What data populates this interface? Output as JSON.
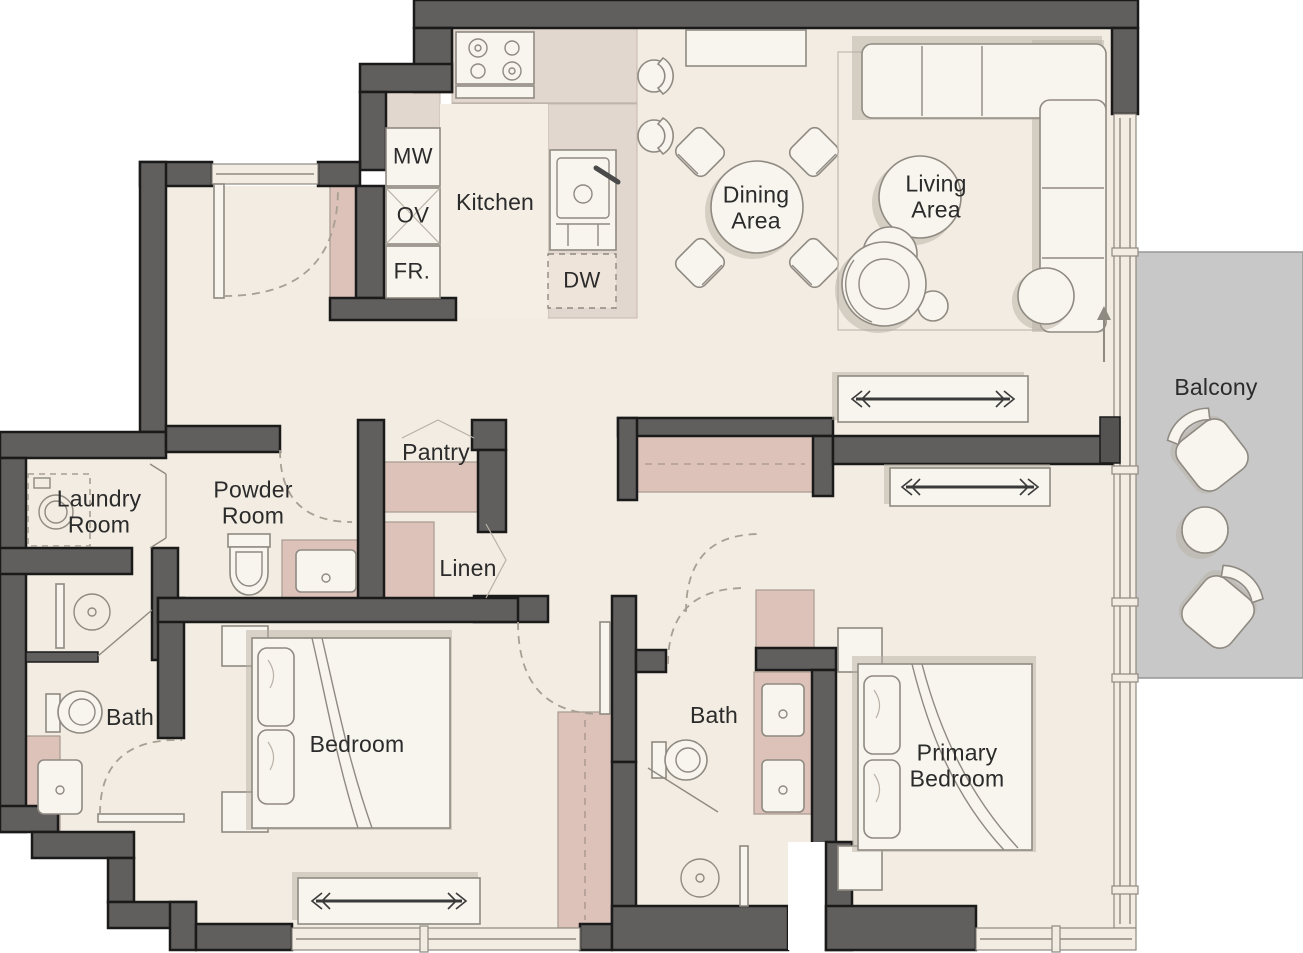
{
  "title": "Apartment Floor Plan",
  "labels": {
    "kitchen": "Kitchen",
    "dining": "Dining\nArea",
    "living": "Living\nArea",
    "balcony": "Balcony",
    "laundry": "Laundry\nRoom",
    "powder": "Powder\nRoom",
    "pantry": "Pantry",
    "linen": "Linen",
    "bath_left": "Bath",
    "bedroom": "Bedroom",
    "bath_primary": "Bath",
    "primary_bedroom": "Primary\nBedroom",
    "microwave": "MW",
    "oven": "OV",
    "fridge": "FR.",
    "dishwasher": "DW"
  },
  "colors": {
    "wall": "#615f5e",
    "ink": "#1a1a1a",
    "floor": "#f2ece2",
    "kfloor": "#f4eee5",
    "counter": "#e2d7cf",
    "pink": "#dcc2b9",
    "white": "#f8f5ee",
    "oline": "#8f8a82",
    "balcony": "#c8c8c8",
    "shadow": "#b7afa4",
    "label": "#2b2b2b",
    "dashc": "#a89f93"
  },
  "rooms": [
    {
      "name": "Kitchen"
    },
    {
      "name": "Dining Area"
    },
    {
      "name": "Living Area"
    },
    {
      "name": "Balcony"
    },
    {
      "name": "Laundry Room"
    },
    {
      "name": "Powder Room"
    },
    {
      "name": "Pantry"
    },
    {
      "name": "Linen"
    },
    {
      "name": "Bath"
    },
    {
      "name": "Bedroom"
    },
    {
      "name": "Bath"
    },
    {
      "name": "Primary Bedroom"
    }
  ]
}
